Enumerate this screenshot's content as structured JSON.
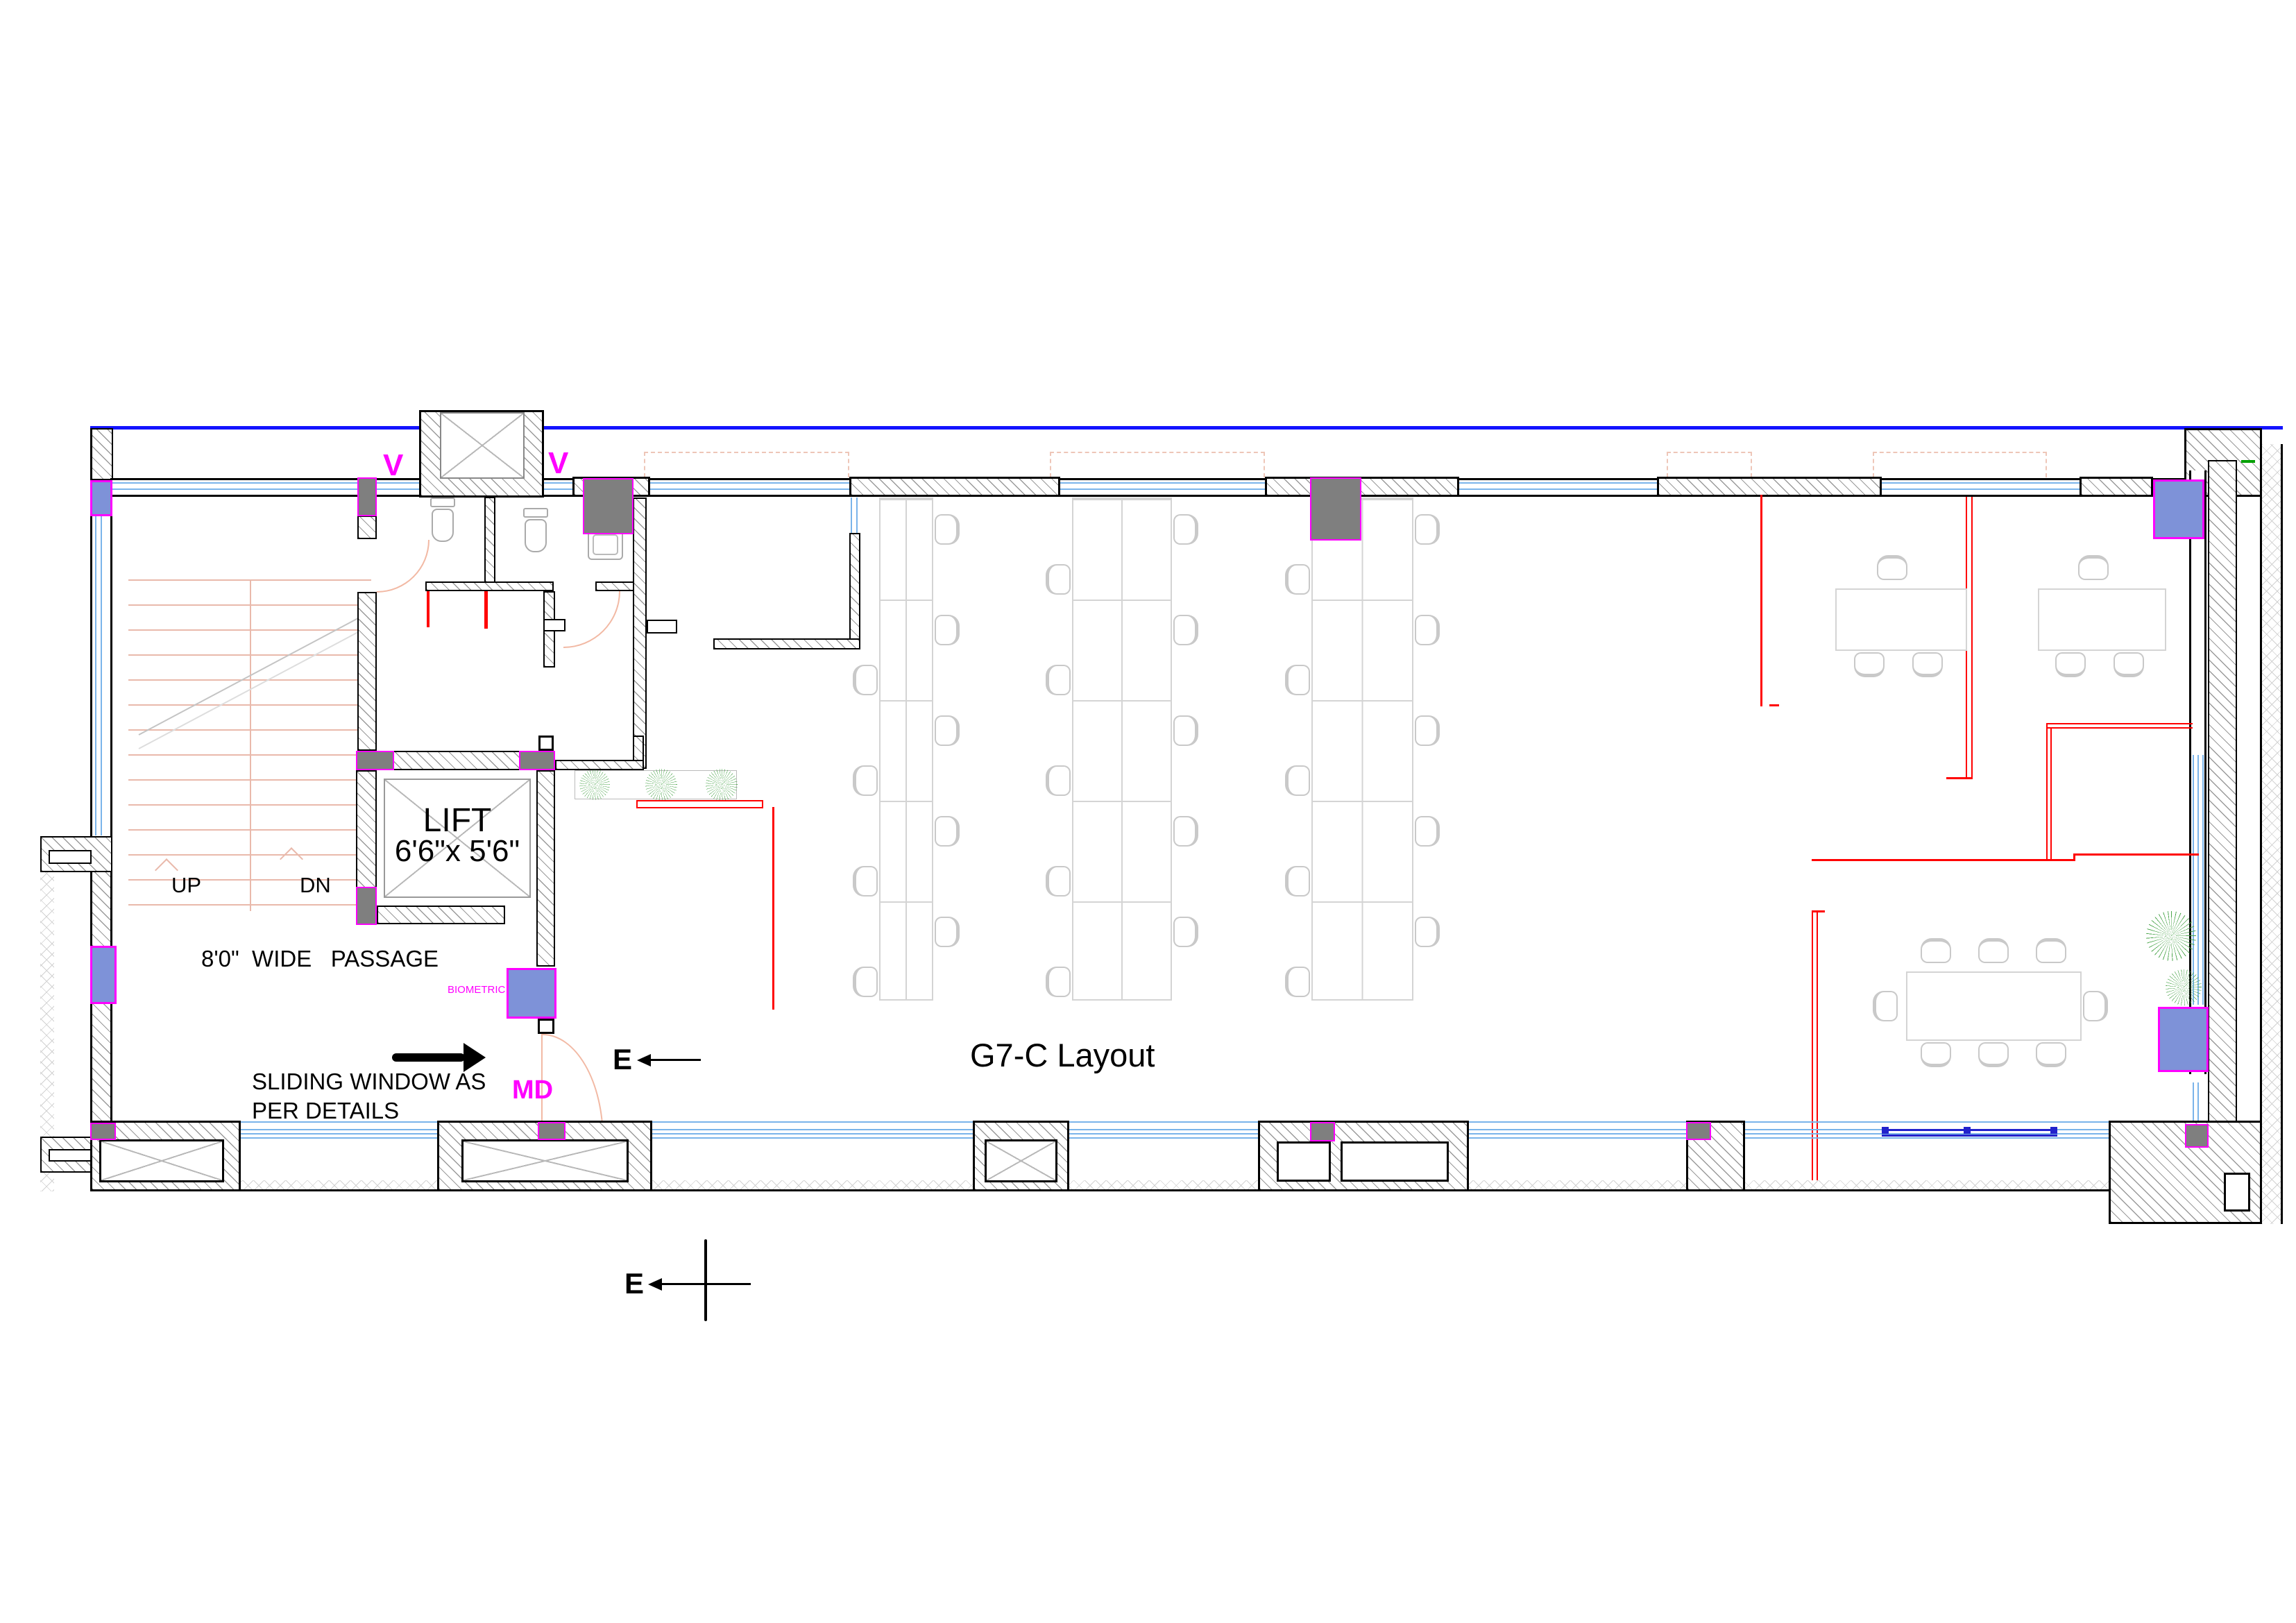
{
  "title": "G7-C Layout",
  "labels": {
    "lift": "LIFT",
    "lift_size": "6'6\"x 5'6\"",
    "up": "UP",
    "dn": "DN",
    "passage": "8'0\"  WIDE   PASSAGE",
    "sliding_window_1": "SLIDING WINDOW AS",
    "sliding_window_2": "PER DETAILS",
    "md": "MD",
    "biometric": "BIOMETRIC",
    "vent": "V",
    "section_marker": "E"
  },
  "colors": {
    "boundary_blue": "#1414ff",
    "glazing_light_blue": "#7ab4ea",
    "window_dark_blue": "#2222cc",
    "column_fill_blue": "#7e92d8",
    "column_gray": "#7f7f7f",
    "highlight_magenta": "#ff00ff",
    "partition_red": "#ff0000",
    "door_salmon": "#f2b9a4",
    "tree_green": "#4aa44a"
  },
  "inventory": {
    "workstation_banks": 3,
    "rows_per_bank": 5,
    "workstation_chairs": 30,
    "cabins": 2,
    "meeting_table_seats": 8,
    "toilet_wc_count": 2,
    "toilet_sink_count": 1,
    "lift_count": 1,
    "stair_flights": 2
  }
}
